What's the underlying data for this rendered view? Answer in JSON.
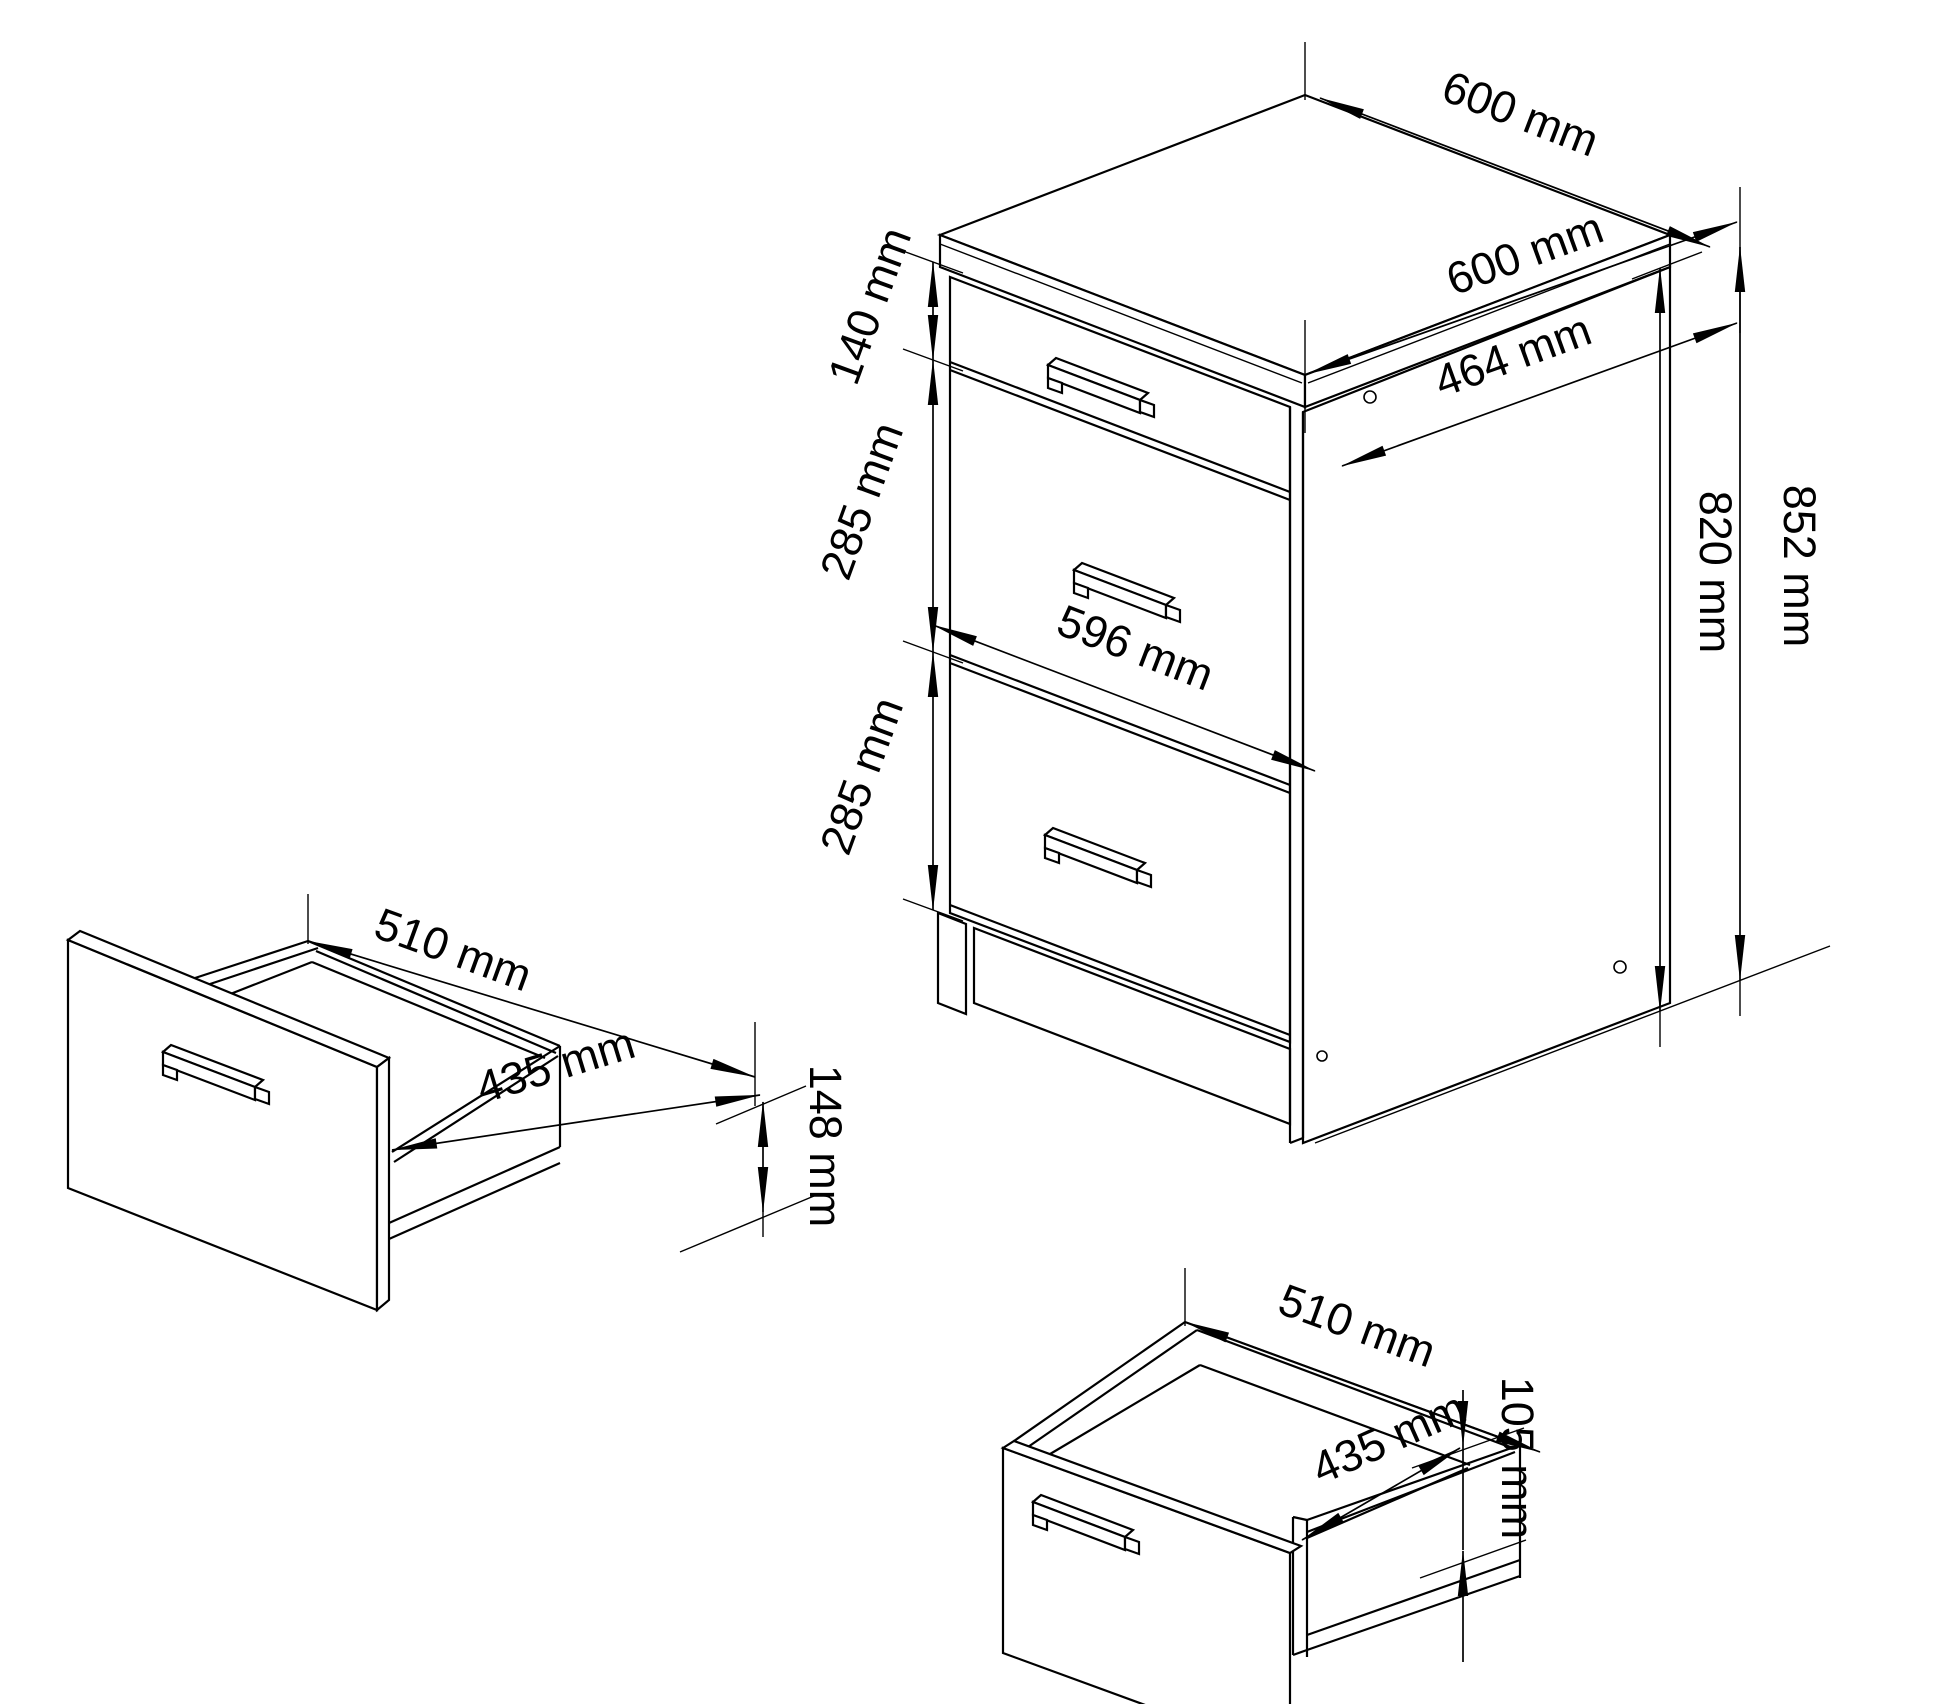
{
  "page": {
    "background": "#ffffff",
    "line_color": "#000000"
  },
  "views": {
    "cabinet": {
      "dims": [
        {
          "name": "top-depth",
          "label": "600 mm"
        },
        {
          "name": "top-width",
          "label": "600 mm"
        },
        {
          "name": "inner-depth",
          "label": "464 mm"
        },
        {
          "name": "drawer1-height",
          "label": "140 mm"
        },
        {
          "name": "drawer2-height",
          "label": "285 mm"
        },
        {
          "name": "drawer3-height",
          "label": "285 mm"
        },
        {
          "name": "front-width",
          "label": "596 mm"
        },
        {
          "name": "carcass-height",
          "label": "820 mm"
        },
        {
          "name": "total-height",
          "label": "852 mm"
        }
      ]
    },
    "drawer_left": {
      "dims": [
        {
          "name": "box-depth",
          "label": "510 mm"
        },
        {
          "name": "box-width",
          "label": "435 mm"
        },
        {
          "name": "box-height",
          "label": "148 mm"
        }
      ]
    },
    "drawer_bottom": {
      "dims": [
        {
          "name": "box-depth",
          "label": "510 mm"
        },
        {
          "name": "box-width",
          "label": "435 mm"
        },
        {
          "name": "box-height",
          "label": "105 mm"
        }
      ]
    }
  }
}
